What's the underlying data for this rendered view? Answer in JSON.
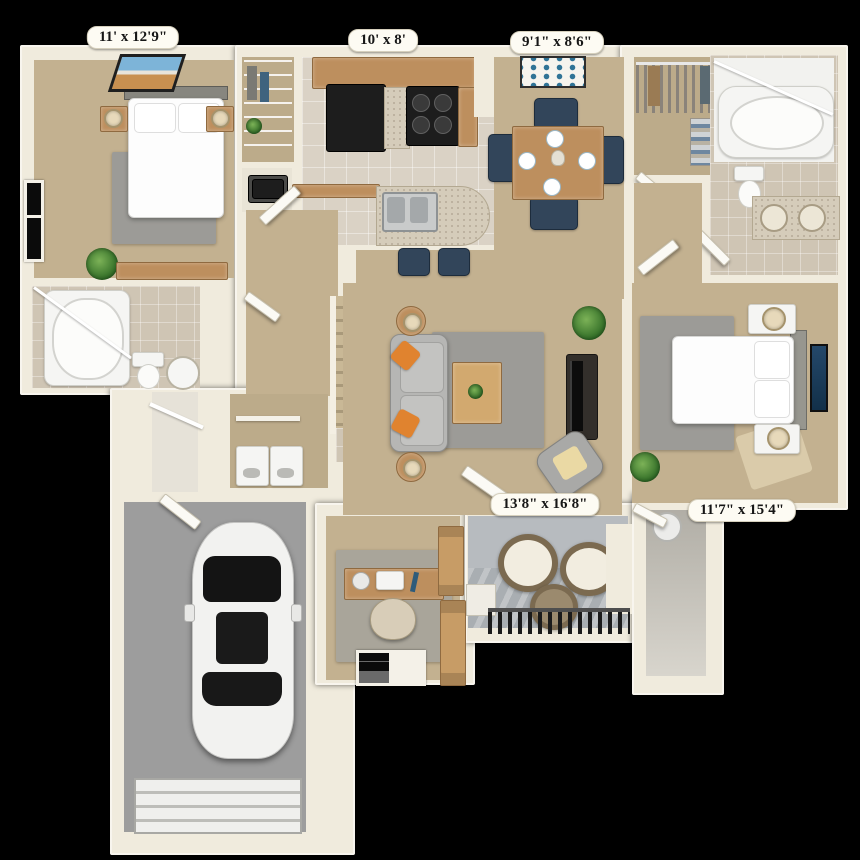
{
  "floorplan": {
    "labels": {
      "bedroom2": "11' x 12'9\"",
      "kitchen": "10' x 8'",
      "dining": "9'1\" x 8'6\"",
      "living": "13'8\" x 16'8\"",
      "master_bedroom": "11'7\" x 15'4\""
    },
    "colors": {
      "background": "#000000",
      "wall": "#f0ebdd",
      "carpet": "#c3b190",
      "tile": "#dad2c5",
      "garage_floor": "#9d9d9d",
      "rug": "#9c9b97",
      "wood": "#bd8f5e",
      "accent_orange": "#e0832f",
      "navy": "#32455a"
    }
  }
}
